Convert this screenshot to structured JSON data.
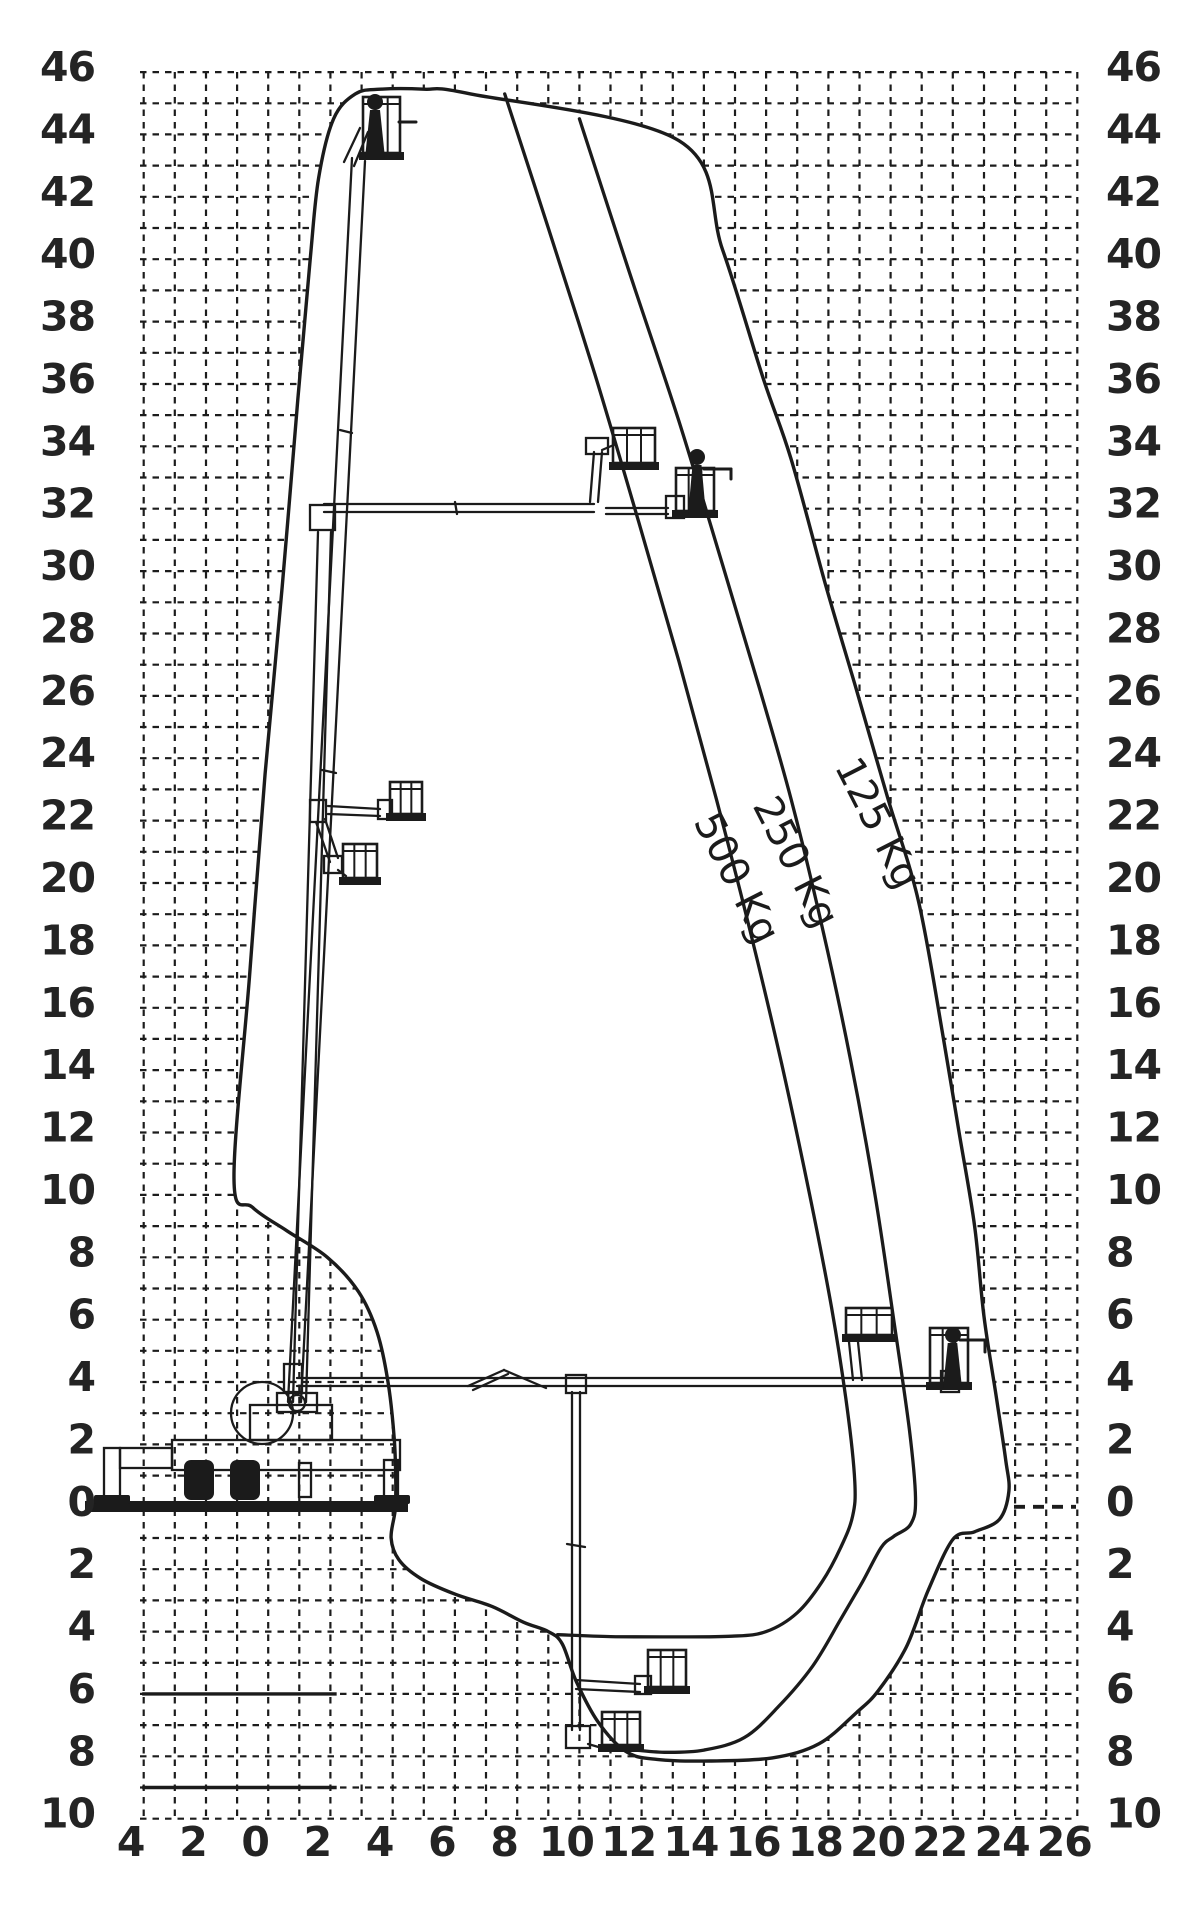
{
  "figure_title": "Aerial platform working envelope / load reach diagram",
  "colors": {
    "ink": "#1b1b1b",
    "grid": "#1c1c1c",
    "background": "#ffffff"
  },
  "chart_data": {
    "type": "area",
    "title": "",
    "xlabel": "outreach (m)",
    "ylabel": "height (m)",
    "units": "m",
    "grid": true,
    "xlim": [
      -4.1,
      26.1
    ],
    "ylim": [
      -10,
      46
    ],
    "x_tick_values": [
      -4,
      -2,
      0,
      2,
      4,
      6,
      8,
      10,
      12,
      14,
      16,
      18,
      20,
      22,
      24,
      26
    ],
    "x_tick_labels": [
      "4",
      "2",
      "0",
      "2",
      "4",
      "6",
      "8",
      "10",
      "12",
      "14",
      "16",
      "18",
      "20",
      "22",
      "24",
      "26"
    ],
    "y_tick_values": [
      46,
      44,
      42,
      40,
      38,
      36,
      34,
      32,
      30,
      28,
      26,
      24,
      22,
      20,
      18,
      16,
      14,
      12,
      10,
      8,
      6,
      4,
      2,
      0,
      -2,
      -4,
      -6,
      -8,
      -10
    ],
    "y_tick_labels": [
      "46",
      "44",
      "42",
      "40",
      "38",
      "36",
      "34",
      "32",
      "30",
      "28",
      "26",
      "24",
      "22",
      "20",
      "18",
      "16",
      "14",
      "12",
      "10",
      "8",
      "6",
      "4",
      "2",
      "0",
      "2",
      "4",
      "6",
      "8",
      "10"
    ],
    "curve_labels": [
      {
        "text": "500 Kg",
        "x_px": 725,
        "y_px": 884,
        "angle": 63
      },
      {
        "text": "250 Kg",
        "x_px": 784,
        "y_px": 868,
        "angle": 63
      },
      {
        "text": "125 Kg",
        "x_px": 866,
        "y_px": 829,
        "angle": 63
      }
    ],
    "series": [
      {
        "name": "125 Kg",
        "role": "outer-envelope",
        "closed": true,
        "points": [
          [
            -1.1,
            10.5
          ],
          [
            -0.6,
            17
          ],
          [
            -0.1,
            23.5
          ],
          [
            0.45,
            29.5
          ],
          [
            0.95,
            35.5
          ],
          [
            1.35,
            40
          ],
          [
            1.62,
            42.6
          ],
          [
            2.1,
            44.5
          ],
          [
            2.8,
            45.3
          ],
          [
            3.6,
            45.45
          ],
          [
            5,
            45.45
          ],
          [
            6.5,
            45.3
          ],
          [
            13.2,
            43.8
          ],
          [
            14.6,
            40.3
          ],
          [
            15.9,
            36.2
          ],
          [
            16.8,
            33.6
          ],
          [
            17.9,
            29.6
          ],
          [
            18.9,
            26.2
          ],
          [
            19.9,
            22.75
          ],
          [
            20.9,
            19.4
          ],
          [
            21.7,
            15.0
          ],
          [
            22.2,
            12.0
          ],
          [
            22.7,
            9.0
          ],
          [
            23.0,
            6.1
          ],
          [
            23.4,
            3.5
          ],
          [
            23.7,
            1.5
          ],
          [
            23.8,
            0.5
          ],
          [
            23.5,
            -0.4
          ],
          [
            22.7,
            -0.8
          ],
          [
            22.0,
            -1.05
          ],
          [
            21.2,
            -2.7
          ],
          [
            20.5,
            -4.5
          ],
          [
            19.6,
            -5.9
          ],
          [
            18.9,
            -6.6
          ],
          [
            17.7,
            -7.6
          ],
          [
            16.2,
            -8.05
          ],
          [
            14.2,
            -8.15
          ],
          [
            12.5,
            -8.1
          ],
          [
            11.5,
            -7.85
          ],
          [
            10.6,
            -6.9
          ],
          [
            9.9,
            -5.6
          ],
          [
            9.45,
            -4.4
          ],
          [
            9.0,
            -4.0
          ],
          [
            8.2,
            -3.7
          ],
          [
            7.2,
            -3.2
          ],
          [
            6.0,
            -2.8
          ],
          [
            4.9,
            -2.3
          ],
          [
            4.2,
            -1.7
          ],
          [
            3.95,
            -1.0
          ],
          [
            4.08,
            -0.1
          ],
          [
            4.1,
            0.8
          ],
          [
            4.05,
            2.2
          ],
          [
            3.85,
            4.0
          ],
          [
            3.5,
            5.6
          ],
          [
            2.9,
            6.9
          ],
          [
            1.9,
            8.0
          ],
          [
            0.6,
            8.85
          ],
          [
            -0.5,
            9.6
          ]
        ]
      },
      {
        "name": "250 Kg",
        "role": "inner-curve",
        "closed": false,
        "points": [
          [
            10.0,
            44.5
          ],
          [
            11.6,
            39.6
          ],
          [
            13.2,
            34.8
          ],
          [
            14.6,
            30.2
          ],
          [
            15.8,
            26.2
          ],
          [
            16.8,
            22.7
          ],
          [
            17.8,
            18.6
          ],
          [
            18.7,
            14.4
          ],
          [
            19.5,
            10.0
          ],
          [
            20.1,
            6.0
          ],
          [
            20.6,
            2.5
          ],
          [
            20.8,
            0.3
          ],
          [
            20.65,
            -0.55
          ],
          [
            20.1,
            -0.95
          ],
          [
            19.7,
            -1.3
          ],
          [
            19.1,
            -2.4
          ],
          [
            18.4,
            -3.6
          ],
          [
            17.5,
            -5.1
          ],
          [
            16.4,
            -6.4
          ],
          [
            15.3,
            -7.4
          ],
          [
            14.0,
            -7.8
          ],
          [
            12.8,
            -7.87
          ],
          [
            11.8,
            -7.8
          ]
        ]
      },
      {
        "name": "500 Kg",
        "role": "inner-curve",
        "closed": false,
        "points": [
          [
            7.6,
            45.3
          ],
          [
            9.0,
            41.0
          ],
          [
            10.5,
            36.3
          ],
          [
            11.9,
            31.6
          ],
          [
            13.2,
            27.1
          ],
          [
            14.4,
            22.7
          ],
          [
            15.5,
            18.4
          ],
          [
            16.5,
            14.2
          ],
          [
            17.4,
            10.0
          ],
          [
            18.1,
            6.4
          ],
          [
            18.6,
            3.2
          ],
          [
            18.85,
            0.8
          ],
          [
            18.78,
            -0.3
          ],
          [
            18.4,
            -1.3
          ],
          [
            17.8,
            -2.4
          ],
          [
            17.0,
            -3.4
          ],
          [
            16.0,
            -4.0
          ],
          [
            14.9,
            -4.15
          ],
          [
            13.0,
            -4.17
          ],
          [
            11.0,
            -4.16
          ],
          [
            9.3,
            -4.1
          ]
        ]
      }
    ],
    "solid_segments_m": [
      {
        "y": -6,
        "x1": -4.05,
        "x2": 2.2
      },
      {
        "y": -9,
        "x1": -4.05,
        "x2": 2.2
      }
    ],
    "layout": {
      "map": {
        "u0": 268.2,
        "ux": 31.12,
        "v0": 1506.8,
        "vy": 31.19
      },
      "plot": {
        "x0": 140,
        "y0": 72,
        "x1": 1076,
        "y1": 1819
      },
      "left_tick_x": 95,
      "right_tick_x": 1106,
      "bottom_tick_y": 1856,
      "bottom_tick_dx": -13,
      "y_tick_dy": 9
    }
  },
  "machine": {
    "ground_bar": [
      85,
      1501,
      323,
      11
    ],
    "flines": [
      [
        288,
        1402,
        352,
        158
      ],
      [
        301,
        1402,
        365,
        161
      ],
      [
        322,
        770,
        336,
        773
      ],
      [
        340,
        430,
        352,
        433
      ],
      [
        344,
        162,
        360,
        128
      ],
      [
        354,
        166,
        368,
        132
      ],
      [
        399,
        122,
        416,
        122,
        3
      ],
      [
        293,
        1402,
        318,
        532
      ],
      [
        306,
        1402,
        331,
        532
      ],
      [
        324,
        504,
        594,
        504
      ],
      [
        324,
        512,
        594,
        512
      ],
      [
        455,
        502,
        457,
        514
      ],
      [
        590,
        502,
        594,
        452
      ],
      [
        598,
        502,
        602,
        452
      ],
      [
        602,
        450,
        616,
        444
      ],
      [
        606,
        508,
        668,
        508
      ],
      [
        606,
        514,
        668,
        514
      ],
      [
        704,
        469,
        731,
        469,
        3
      ],
      [
        731,
        469,
        731,
        479,
        3
      ],
      [
        328,
        806,
        380,
        809
      ],
      [
        328,
        814,
        380,
        816
      ],
      [
        316,
        822,
        330,
        862
      ],
      [
        325,
        819,
        338,
        858
      ],
      [
        338,
        870,
        346,
        876
      ],
      [
        297,
        1378,
        946,
        1378
      ],
      [
        297,
        1386,
        946,
        1386
      ],
      [
        468,
        1386,
        504,
        1370
      ],
      [
        504,
        1370,
        546,
        1388
      ],
      [
        473,
        1390,
        508,
        1374
      ],
      [
        849,
        1342,
        853,
        1380
      ],
      [
        858,
        1342,
        862,
        1380
      ],
      [
        960,
        1340,
        985,
        1340,
        3
      ],
      [
        985,
        1340,
        985,
        1352,
        3
      ],
      [
        572,
        1392,
        572,
        1730
      ],
      [
        580,
        1392,
        580,
        1730
      ],
      [
        567,
        1544,
        585,
        1547
      ],
      [
        588,
        1744,
        602,
        1748
      ],
      [
        576,
        1680,
        640,
        1684
      ],
      [
        576,
        1689,
        640,
        1692
      ]
    ],
    "rects": [
      [
        310,
        505,
        25,
        25
      ],
      [
        586,
        438,
        22,
        16
      ],
      [
        666,
        496,
        18,
        22
      ],
      [
        310,
        800,
        16,
        22
      ],
      [
        378,
        800,
        14,
        19
      ],
      [
        324,
        856,
        18,
        17
      ],
      [
        284,
        1364,
        18,
        28
      ],
      [
        566,
        1375,
        20,
        18
      ],
      [
        941,
        1371,
        18,
        21
      ],
      [
        566,
        1726,
        24,
        22
      ],
      [
        635,
        1676,
        16,
        18
      ],
      [
        172,
        1440,
        228,
        30
      ],
      [
        120,
        1448,
        52,
        20
      ],
      [
        104,
        1448,
        16,
        52
      ],
      [
        384,
        1460,
        14,
        40
      ],
      [
        250,
        1405,
        82,
        35
      ],
      [
        277,
        1393,
        40,
        19
      ],
      [
        299,
        1463,
        12,
        34
      ]
    ],
    "fills": [
      [
        94,
        1495,
        36,
        9,
        2
      ],
      [
        374,
        1495,
        36,
        9,
        2
      ],
      [
        184,
        1460,
        30,
        40,
        7
      ],
      [
        230,
        1460,
        30,
        40,
        7
      ]
    ],
    "circles": [
      [
        262,
        1413,
        31
      ],
      [
        297,
        1403,
        8
      ]
    ],
    "baskets": [
      [
        363,
        97,
        37,
        63
      ],
      [
        613,
        428,
        42,
        42
      ],
      [
        676,
        468,
        38,
        50
      ],
      [
        390,
        782,
        32,
        39
      ],
      [
        343,
        844,
        34,
        41
      ],
      [
        930,
        1328,
        38,
        62
      ],
      [
        846,
        1308,
        46,
        34
      ],
      [
        648,
        1650,
        38,
        44
      ],
      [
        602,
        1712,
        38,
        40
      ]
    ],
    "figures": [
      {
        "head": [
          375,
          102,
          8
        ],
        "body": [
          365,
          110,
          20,
          48
        ]
      },
      {
        "head": [
          697,
          457,
          8
        ],
        "body": [
          688,
          465,
          18,
          50
        ]
      },
      {
        "head": [
          953,
          1335,
          8
        ],
        "body": [
          943,
          1343,
          19,
          45
        ]
      }
    ]
  }
}
